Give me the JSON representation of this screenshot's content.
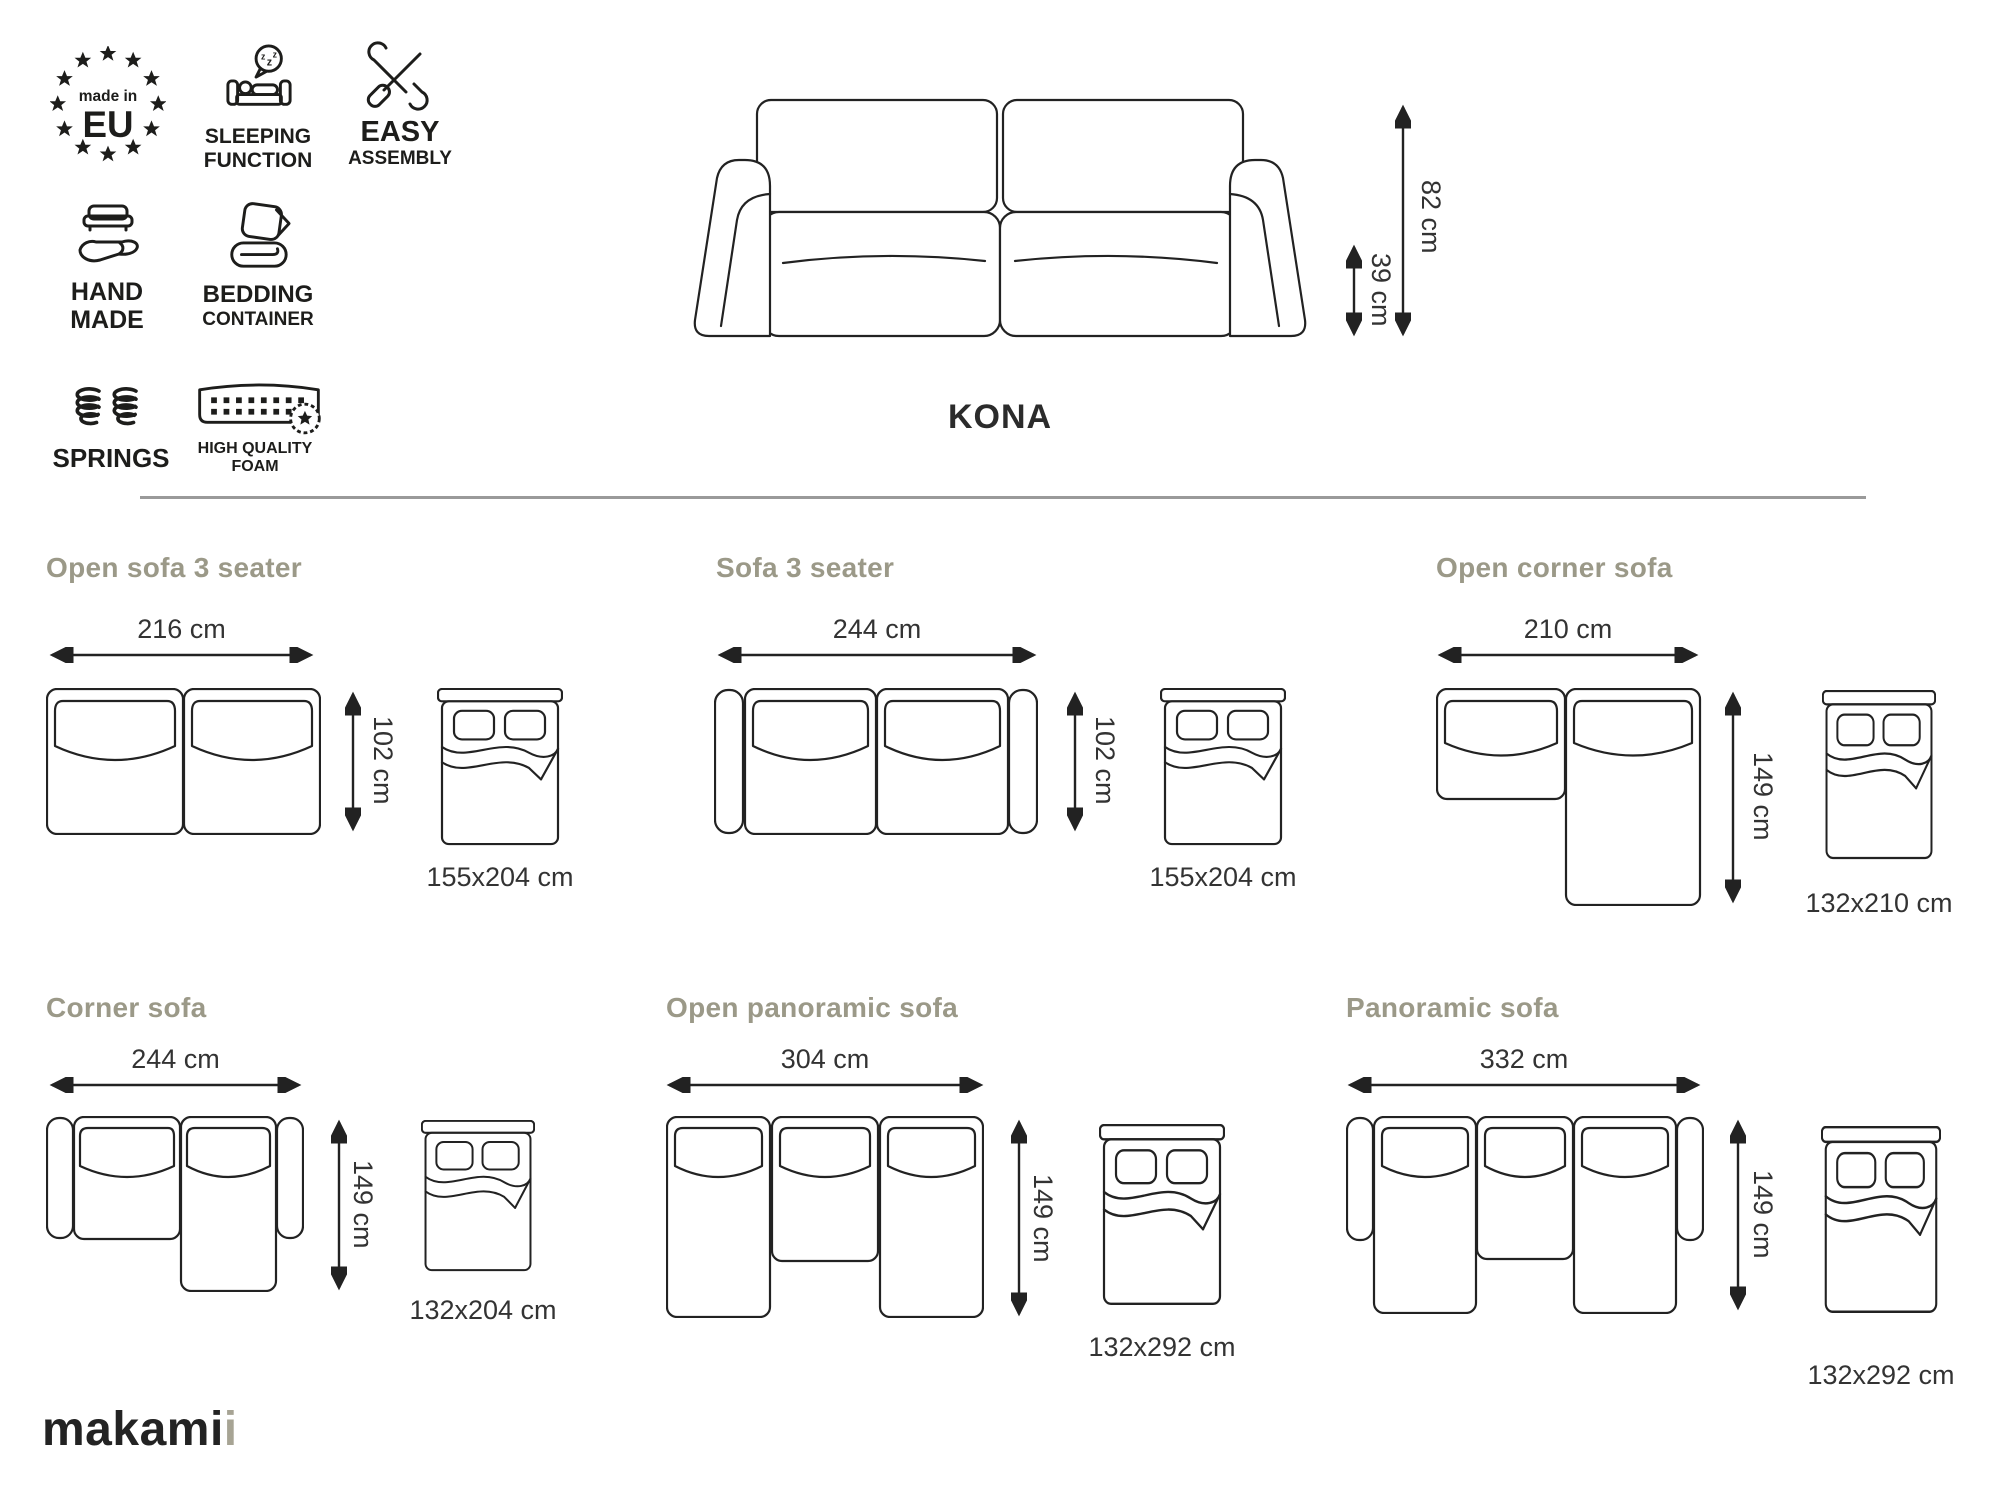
{
  "product": {
    "name": "KONA",
    "total_height": "82 cm",
    "seat_height": "39 cm"
  },
  "badges": {
    "made_in_eu": {
      "line1": "made in",
      "line2": "EU"
    },
    "sleeping_function": {
      "line1": "SLEEPING",
      "line2": "FUNCTION"
    },
    "easy_assembly": {
      "line1": "EASY",
      "line2": "ASSEMBLY"
    },
    "hand_made": {
      "line1": "HAND",
      "line2": "MADE"
    },
    "bedding_container": {
      "line1": "BEDDING",
      "line2": "CONTAINER"
    },
    "springs": {
      "line1": "SPRINGS"
    },
    "high_quality_foam": {
      "line1": "HIGH QUALITY",
      "line2": "FOAM"
    }
  },
  "variants": [
    {
      "name": "Open sofa 3 seater",
      "width": "216 cm",
      "depth": "102 cm",
      "bed": "155x204 cm"
    },
    {
      "name": "Sofa 3 seater",
      "width": "244 cm",
      "depth": "102 cm",
      "bed": "155x204 cm"
    },
    {
      "name": "Open corner sofa",
      "width": "210 cm",
      "depth": "149 cm",
      "bed": "132x210 cm"
    },
    {
      "name": "Corner sofa",
      "width": "244 cm",
      "depth": "149 cm",
      "bed": "132x204 cm"
    },
    {
      "name": "Open panoramic sofa",
      "width": "304 cm",
      "depth": "149 cm",
      "bed": "132x292 cm"
    },
    {
      "name": "Panoramic sofa",
      "width": "332 cm",
      "depth": "149 cm",
      "bed": "132x292 cm"
    }
  ],
  "logo": {
    "main": "makami",
    "accent": "i"
  },
  "colors": {
    "line": "#222222",
    "title": "#9b9988",
    "divider": "#9a9a9a",
    "text": "#333333",
    "logo_accent": "#a7a494"
  }
}
